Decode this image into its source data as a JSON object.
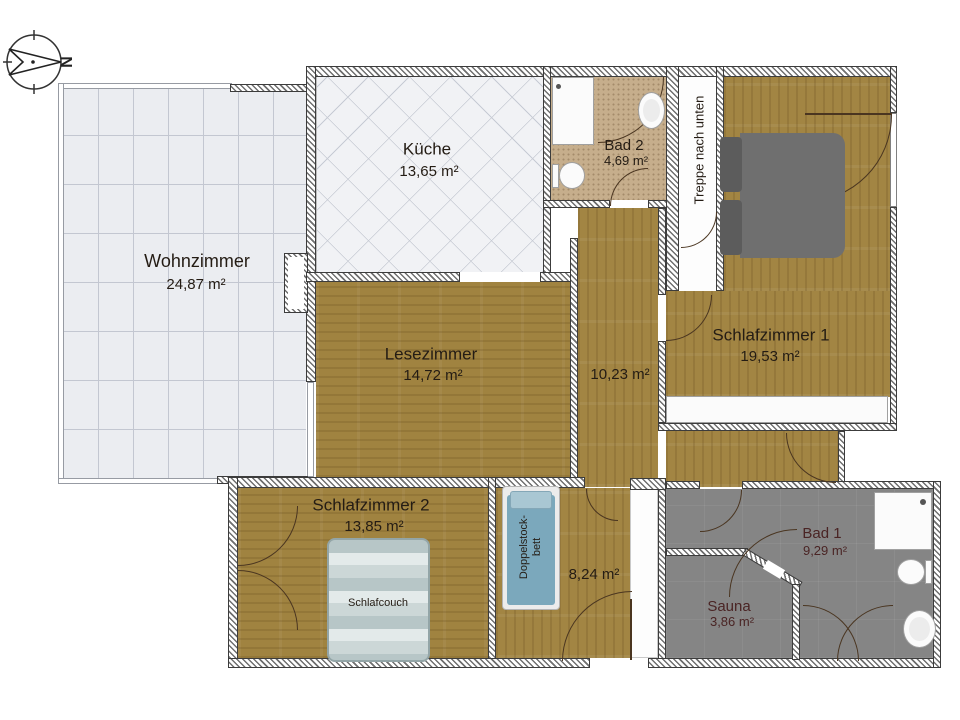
{
  "compass": {
    "north_label": "N"
  },
  "rooms": {
    "wohnzimmer": {
      "name": "Wohnzimmer",
      "area": "24,87 m²"
    },
    "kueche": {
      "name": "Küche",
      "area": "13,65 m²"
    },
    "bad2": {
      "name": "Bad 2",
      "area": "4,69 m²"
    },
    "treppe": {
      "label": "Treppe nach unten"
    },
    "schlafzimmer1": {
      "name": "Schlafzimmer 1",
      "area": "19,53 m²"
    },
    "lesezimmer": {
      "name": "Lesezimmer",
      "area": "14,72 m²"
    },
    "flur_og": {
      "area": "10,23 m²"
    },
    "schlafzimmer2": {
      "name": "Schlafzimmer 2",
      "area": "13,85 m²"
    },
    "flur_eg": {
      "area": "8,24 m²"
    },
    "bad1": {
      "name": "Bad 1",
      "area": "9,29 m²"
    },
    "sauna": {
      "name": "Sauna",
      "area": "3,86 m²"
    }
  },
  "furniture": {
    "schlafcouch": {
      "label": "Schlafcouch"
    },
    "doppelstockbett": {
      "label_line1": "Doppelstock-",
      "label_line2": "bett"
    }
  },
  "colors": {
    "wood": "#a28543",
    "living_tile": "#ebedf1",
    "kitchen_tile": "#f1f2f5",
    "bath2_floor": "#c6ae8c",
    "bath1_floor": "#858585",
    "bed_gray": "#6f6f6f",
    "couch_blue": "#c3d1d2",
    "bunk_blue": "#7ba8bc",
    "label_dark": "#241c14",
    "label_maroon": "#4a2424"
  }
}
